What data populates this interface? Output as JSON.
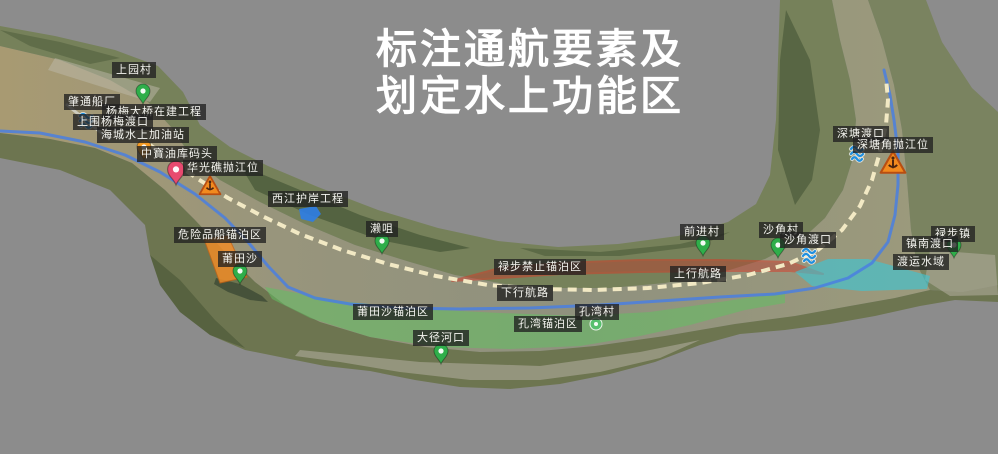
{
  "title": {
    "line1": "标注通航要素及",
    "line2": "划定水上功能区"
  },
  "labels": {
    "shangyuan_village": "上园村",
    "zhaotong_shipyard": "肇通船厂",
    "yangmei_bridge_project": "杨梅大桥在建工程",
    "shangwei_yangmei_ferry": "上围杨梅渡口",
    "haicheng_fuel_station": "海城水上加油站",
    "zhongbao_oil_wharf": "中寶油库码头",
    "huaguangjiao_dump_site": "华光礁抛江位",
    "xijiang_revetment_project": "西江护岸工程",
    "laizui": "濑咀",
    "dangerous_cargo_anchorage": "危险品船锚泊区",
    "putiansha": "莆田沙",
    "putiansha_anchorage": "莆田沙锚泊区",
    "dajing_estuary": "大径河口",
    "kongwan_anchorage": "孔湾锚泊区",
    "kongwan_village": "孔湾村",
    "downstream_route": "下行航路",
    "lubu_no_anchor_zone": "禄步禁止锚泊区",
    "upstream_route": "上行航路",
    "qianjin_village": "前进村",
    "shajiao_village": "沙角村",
    "shajiao_ferry": "沙角渡口",
    "lubu_town": "禄步镇",
    "zhennan_ferry": "镇南渡口",
    "ferry_water_area": "渡运水域",
    "shentang_ferry": "深塘渡口",
    "shentangjiao_dump_site": "深塘角抛江位"
  },
  "icons": {
    "village_pin": "map-pin",
    "wharf_pin": "map-pin",
    "spot_pin": "map-pin",
    "ferry": "ferry-waves",
    "hazard": "warning-triangle",
    "revetment": "water-patch"
  },
  "colors": {
    "background_gray": "#8c8c8c",
    "channel_dashed_line": "#f2e9c4",
    "route_blue_line": "#4a7fe0",
    "anchorage_zone_green": "#62bf62",
    "dangerous_zone_orange": "#f08c28",
    "no_anchor_zone_red": "#c0392b",
    "ferry_water_cyan": "#39c8d8",
    "village_pin_green": "#2fae4a",
    "wharf_pin_orange": "#f59a23",
    "spot_pin_pink": "#e84a6f",
    "ferry_icon_blue": "#1f8fe0",
    "warning_triangle_orange": "#f28a1e"
  }
}
